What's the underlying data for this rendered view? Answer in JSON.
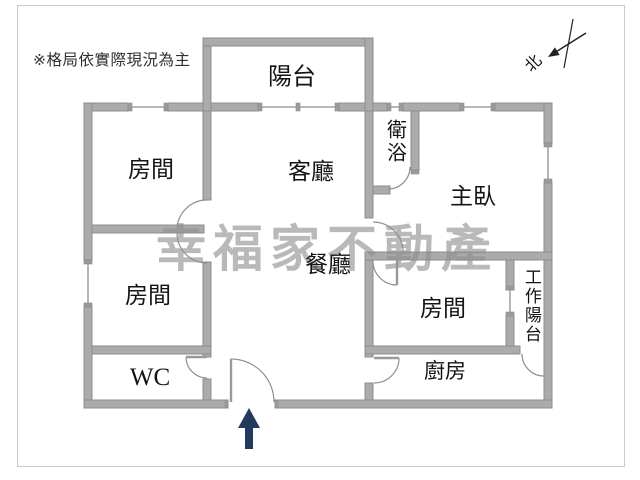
{
  "disclaimer": "※格局依實際現況為主",
  "watermark": "幸福家不動產",
  "compass": {
    "north_label": "北"
  },
  "rooms": {
    "balcony": "陽台",
    "room_top_left": "房間",
    "living": "客廳",
    "bath": "衛浴",
    "master": "主臥",
    "dining": "餐廳",
    "room_mid_left": "房間",
    "wc": "WC",
    "room_bottom_right": "房間",
    "work_balcony": "工作陽台",
    "kitchen": "廚房"
  },
  "colors": {
    "wall": "#ababab",
    "wall_outline": "#8c8c8c",
    "window_line": "#8f8f8f",
    "entrance_arrow": "#233a5e",
    "watermark": "#8f8f8f",
    "text": "#141414",
    "frame": "#cbcbcb"
  }
}
